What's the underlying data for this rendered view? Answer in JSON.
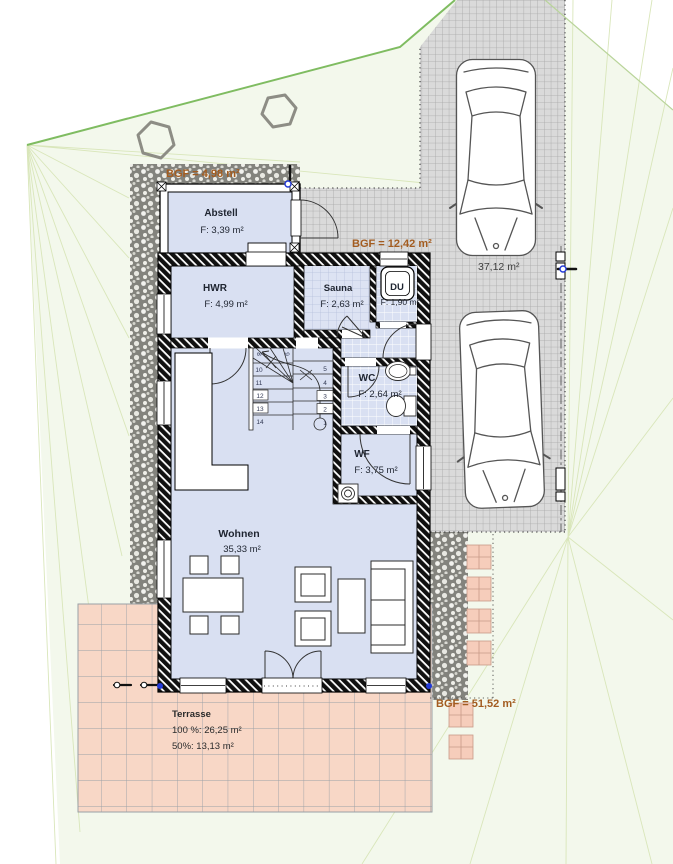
{
  "colors": {
    "site_fill": "#f3f8ec",
    "boundary_green": "#7fbc61",
    "contour_line": "#d9e6ba",
    "gravel_gray": "#83837d",
    "driveway_fill": "#dadada",
    "room_fill": "#d9e0f2",
    "terrace_fill": "#f8d7c6",
    "accent_orange": "#a35c20",
    "marker_blue": "#2239d8",
    "wall_black": "#101010"
  },
  "site": {
    "bgf_annex": "BGF = 4,98 m²",
    "bgf_main": "BGF = 12,42 m²",
    "bgf_total": "BGF = 51,52 m²",
    "driveway_area": "37,12 m²"
  },
  "rooms": {
    "abstell": {
      "name": "Abstell",
      "area": "F: 3,39 m²"
    },
    "hwr": {
      "name": "HWR",
      "area": "F: 4,99 m²"
    },
    "sauna": {
      "name": "Sauna",
      "area": "F: 2,63 m²"
    },
    "du": {
      "name": "DU",
      "area": "F: 1,90 m²"
    },
    "wc": {
      "name": "WC",
      "area": "F: 2,64 m²"
    },
    "wf": {
      "name": "WF",
      "area": "F: 3,75 m²"
    },
    "wohnen": {
      "name": "Wohnen",
      "area": "35,33 m²"
    }
  },
  "terrace": {
    "name": "Terrasse",
    "full": "100 %: 26,25 m²",
    "half": "50%:    13,13 m²"
  },
  "stairs": {
    "left": [
      "10",
      "11",
      "12",
      "13",
      "14"
    ],
    "right": [
      "5",
      "4",
      "3",
      "2",
      "1"
    ],
    "top": [
      "8",
      "9"
    ]
  }
}
